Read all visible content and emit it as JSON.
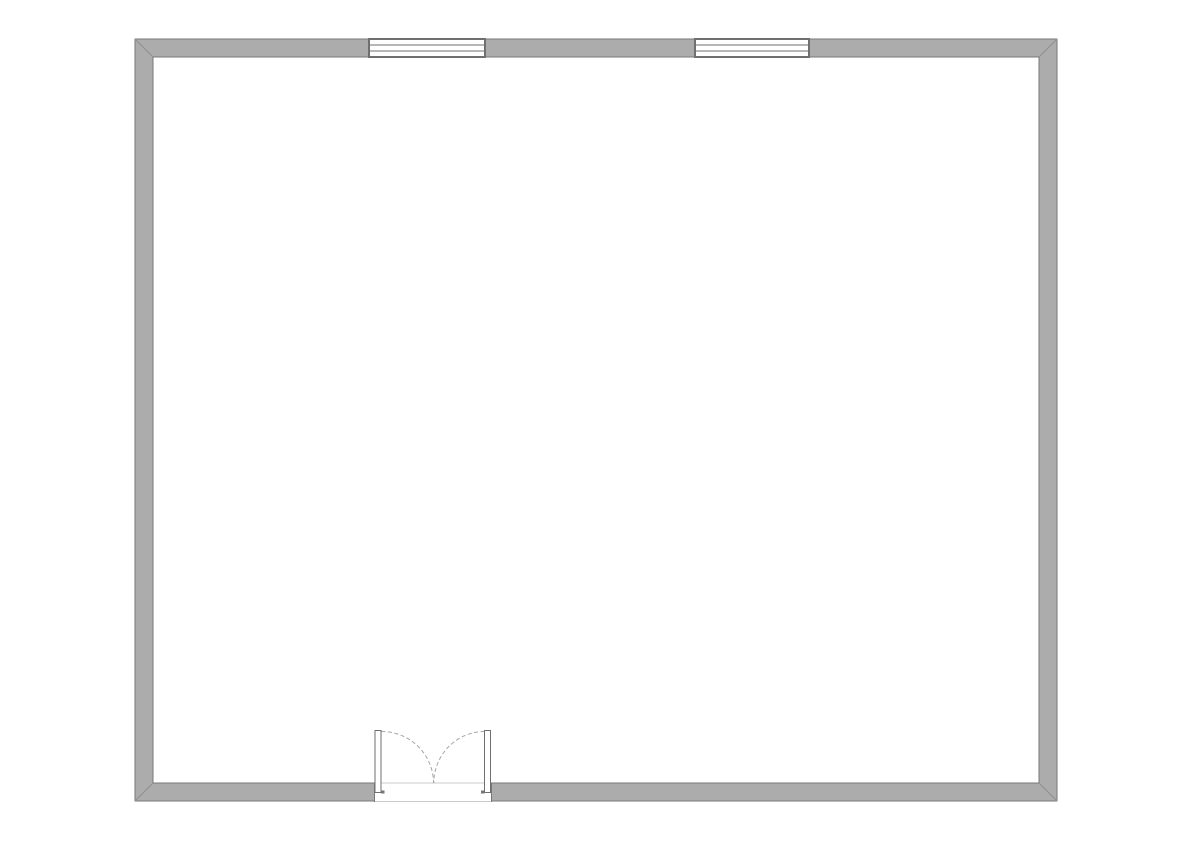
{
  "app": {
    "background": "#ffffff",
    "canvas_width": 1191,
    "canvas_height": 842
  },
  "floorplan": {
    "wall": {
      "outer": {
        "x": 135,
        "y": 39,
        "width": 922,
        "height": 762
      },
      "thickness": 18,
      "fill": "#ACACAC",
      "outline": "#777777",
      "miter_color": "#8F8F8F"
    },
    "windows": {
      "frame_color": "#6F6F6F",
      "fill": "#FFFFFF",
      "pane_line_offsets": [
        6,
        12
      ],
      "items": [
        {
          "name": "north-window-left",
          "x": 369,
          "y": 39,
          "width": 116,
          "height": 18
        },
        {
          "name": "north-window-right",
          "x": 695,
          "y": 39,
          "width": 114,
          "height": 18
        }
      ]
    },
    "door": {
      "name": "south-double-door",
      "opening": {
        "x": 374.5,
        "y": 782.5,
        "width": 117,
        "height": 19.5
      },
      "threshold_color": "#CBCBCB",
      "jamb_color": "#777777",
      "leaf_fill": "#FFFFFF",
      "leaf_frame_color": "#6F6F6F",
      "leaves": [
        {
          "name": "left-leaf",
          "x": 375,
          "y": 730.5,
          "width": 6,
          "height": 62
        },
        {
          "name": "right-leaf",
          "x": 484.5,
          "y": 730.5,
          "width": 6,
          "height": 62
        }
      ],
      "feet": [
        {
          "x": 381,
          "y": 790.5,
          "width": 3.5,
          "height": 3
        },
        {
          "x": 481,
          "y": 790.5,
          "width": 3.5,
          "height": 3
        }
      ],
      "swing": {
        "color": "#A6A6A6",
        "dash": "4 2.5",
        "paths": [
          "M 381.5 731.5 A 52 51.5 0 0 1 433.5 783",
          "M 484.5 731.5 A 51 51.5 0 0 0 433.8 783"
        ]
      }
    }
  }
}
